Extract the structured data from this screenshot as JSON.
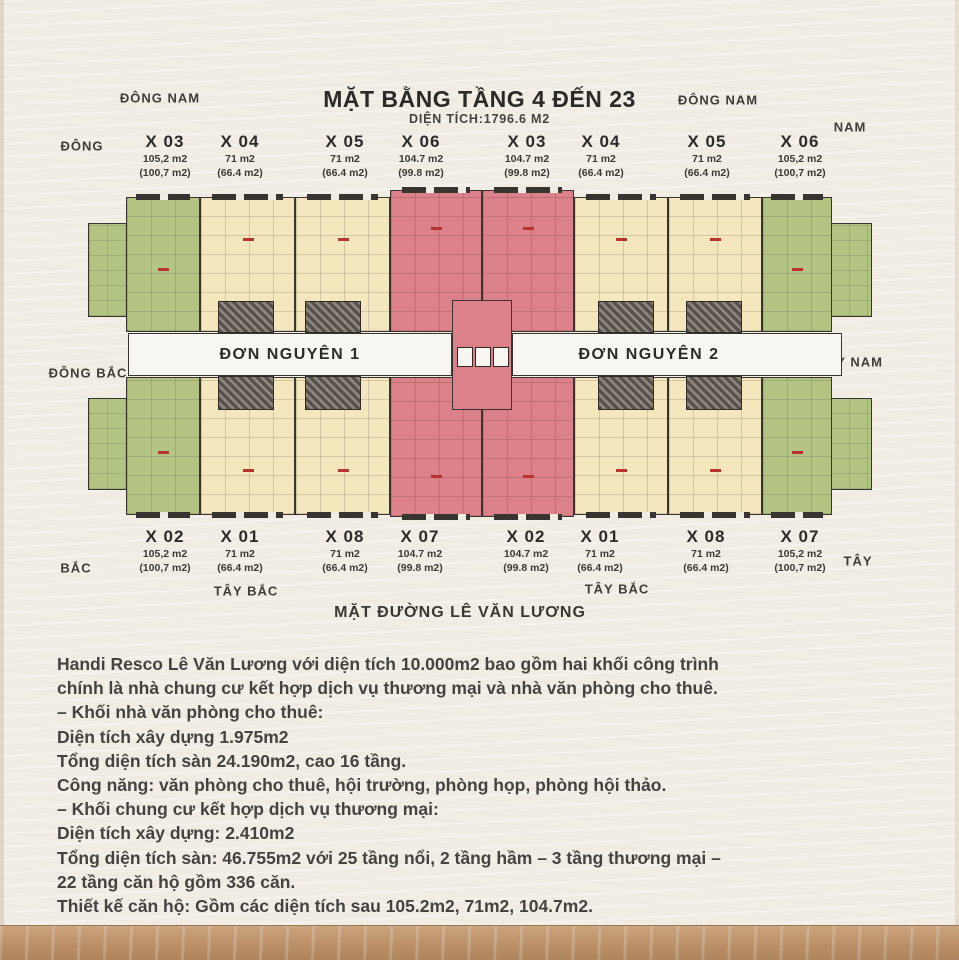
{
  "header": {
    "title": "MẶT BẰNG TẦNG 4 ĐẾN 23",
    "subtitle": "DIỆN TÍCH:1796.6 M2"
  },
  "compass": {
    "top_left": "ĐÔNG NAM",
    "top_right": "ĐÔNG NAM",
    "left": "ĐÔNG",
    "nam": "NAM",
    "mid_left": "ĐÔNG BẮC",
    "mid_right": "TÂY NAM",
    "bottom_left": "BẮC",
    "tay_bac_1": "TÂY BẮC",
    "tay_bac_2": "TÂY BẮC",
    "bottom_right": "TÂY"
  },
  "corridors": {
    "don_nguyen_1": "ĐƠN NGUYÊN 1",
    "don_nguyen_2": "ĐƠN NGUYÊN 2"
  },
  "units_top": [
    {
      "id": "X 03",
      "area": "105,2 m2",
      "area_net": "(100,7 m2)"
    },
    {
      "id": "X 04",
      "area": "71 m2",
      "area_net": "(66.4 m2)"
    },
    {
      "id": "X 05",
      "area": "71 m2",
      "area_net": "(66.4 m2)"
    },
    {
      "id": "X 06",
      "area": "104.7 m2",
      "area_net": "(99.8 m2)"
    },
    {
      "id": "X 03",
      "area": "104.7 m2",
      "area_net": "(99.8 m2)"
    },
    {
      "id": "X 04",
      "area": "71 m2",
      "area_net": "(66.4 m2)"
    },
    {
      "id": "X 05",
      "area": "71 m2",
      "area_net": "(66.4 m2)"
    },
    {
      "id": "X 06",
      "area": "105,2 m2",
      "area_net": "(100,7 m2)"
    }
  ],
  "units_bottom": [
    {
      "id": "X 02",
      "area": "105,2 m2",
      "area_net": "(100,7 m2)"
    },
    {
      "id": "X 01",
      "area": "71 m2",
      "area_net": "(66.4 m2)"
    },
    {
      "id": "X 08",
      "area": "71 m2",
      "area_net": "(66.4 m2)"
    },
    {
      "id": "X 07",
      "area": "104.7 m2",
      "area_net": "(99.8 m2)"
    },
    {
      "id": "X 02",
      "area": "104.7 m2",
      "area_net": "(99.8 m2)"
    },
    {
      "id": "X 01",
      "area": "71 m2",
      "area_net": "(66.4 m2)"
    },
    {
      "id": "X 08",
      "area": "71 m2",
      "area_net": "(66.4 m2)"
    },
    {
      "id": "X 07",
      "area": "105,2 m2",
      "area_net": "(100,7 m2)"
    }
  ],
  "street_label": "MẶT ĐƯỜNG LÊ VĂN LƯƠNG",
  "description": [
    "Handi Resco Lê Văn Lương với diện tích 10.000m2 bao gồm hai khối công trình",
    "chính là nhà chung cư kết hợp dịch vụ thương mại và nhà văn phòng cho thuê.",
    "– Khối nhà văn phòng cho thuê:",
    "Diện tích xây dựng 1.975m2",
    "Tổng diện tích sàn 24.190m2, cao 16 tầng.",
    "Công năng: văn phòng cho thuê, hội trường, phòng họp, phòng hội thảo.",
    "– Khối chung cư kết hợp dịch vụ thương mại:",
    "Diện tích xây dựng: 2.410m2",
    "Tổng diện tích sàn: 46.755m2 với 25 tầng nổi, 2 tầng hầm – 3 tầng thương mại –",
    "22 tầng căn hộ gồm 336 căn.",
    "Thiết kế căn hộ: Gồm các diện tích sau 105.2m2, 71m2, 104.7m2."
  ],
  "colors": {
    "background": "#f1ede5",
    "unit_green": "#b4c583",
    "unit_cream": "#f4e7bd",
    "unit_pink": "#dc8089",
    "walls": "#38342f",
    "corridor_fill": "#f8f6f0",
    "text_dark": "#2d2b28",
    "wood_frame": "#bb9068",
    "unit_marker_red": "#b8352f"
  }
}
